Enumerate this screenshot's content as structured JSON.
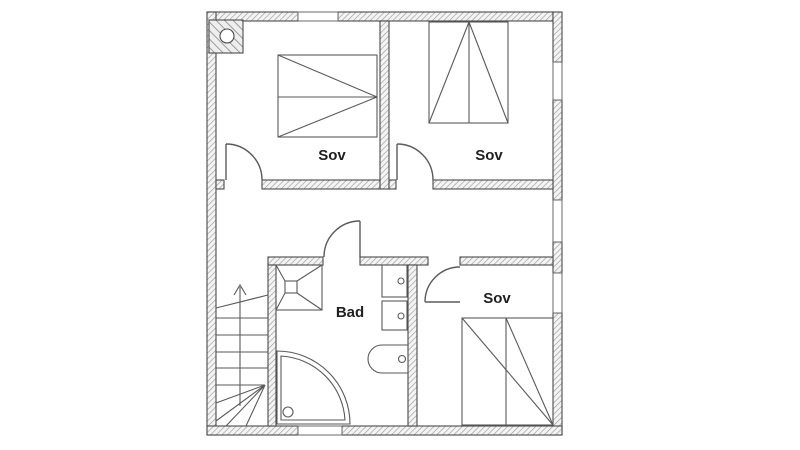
{
  "plan": {
    "title": "second-floor-plan",
    "rooms": [
      {
        "id": "bedroom-left",
        "label": "Sov"
      },
      {
        "id": "bedroom-top-right",
        "label": "Sov"
      },
      {
        "id": "bedroom-bottom-right",
        "label": "Sov"
      },
      {
        "id": "bathroom",
        "label": "Bad"
      }
    ],
    "symbols": [
      "chimney",
      "stairs-up-arrow",
      "winder-staircase",
      "double-bed",
      "single-bed",
      "shower-tray-with-drain",
      "corner-shower",
      "washer-cabinet",
      "toilet",
      "door-swing",
      "window"
    ],
    "colors": {
      "wall_outline": "#4a4a4a",
      "wall_hatch": "#9a9a9a",
      "line": "#555555",
      "text": "#1f1f1f",
      "background": "#ffffff"
    }
  }
}
